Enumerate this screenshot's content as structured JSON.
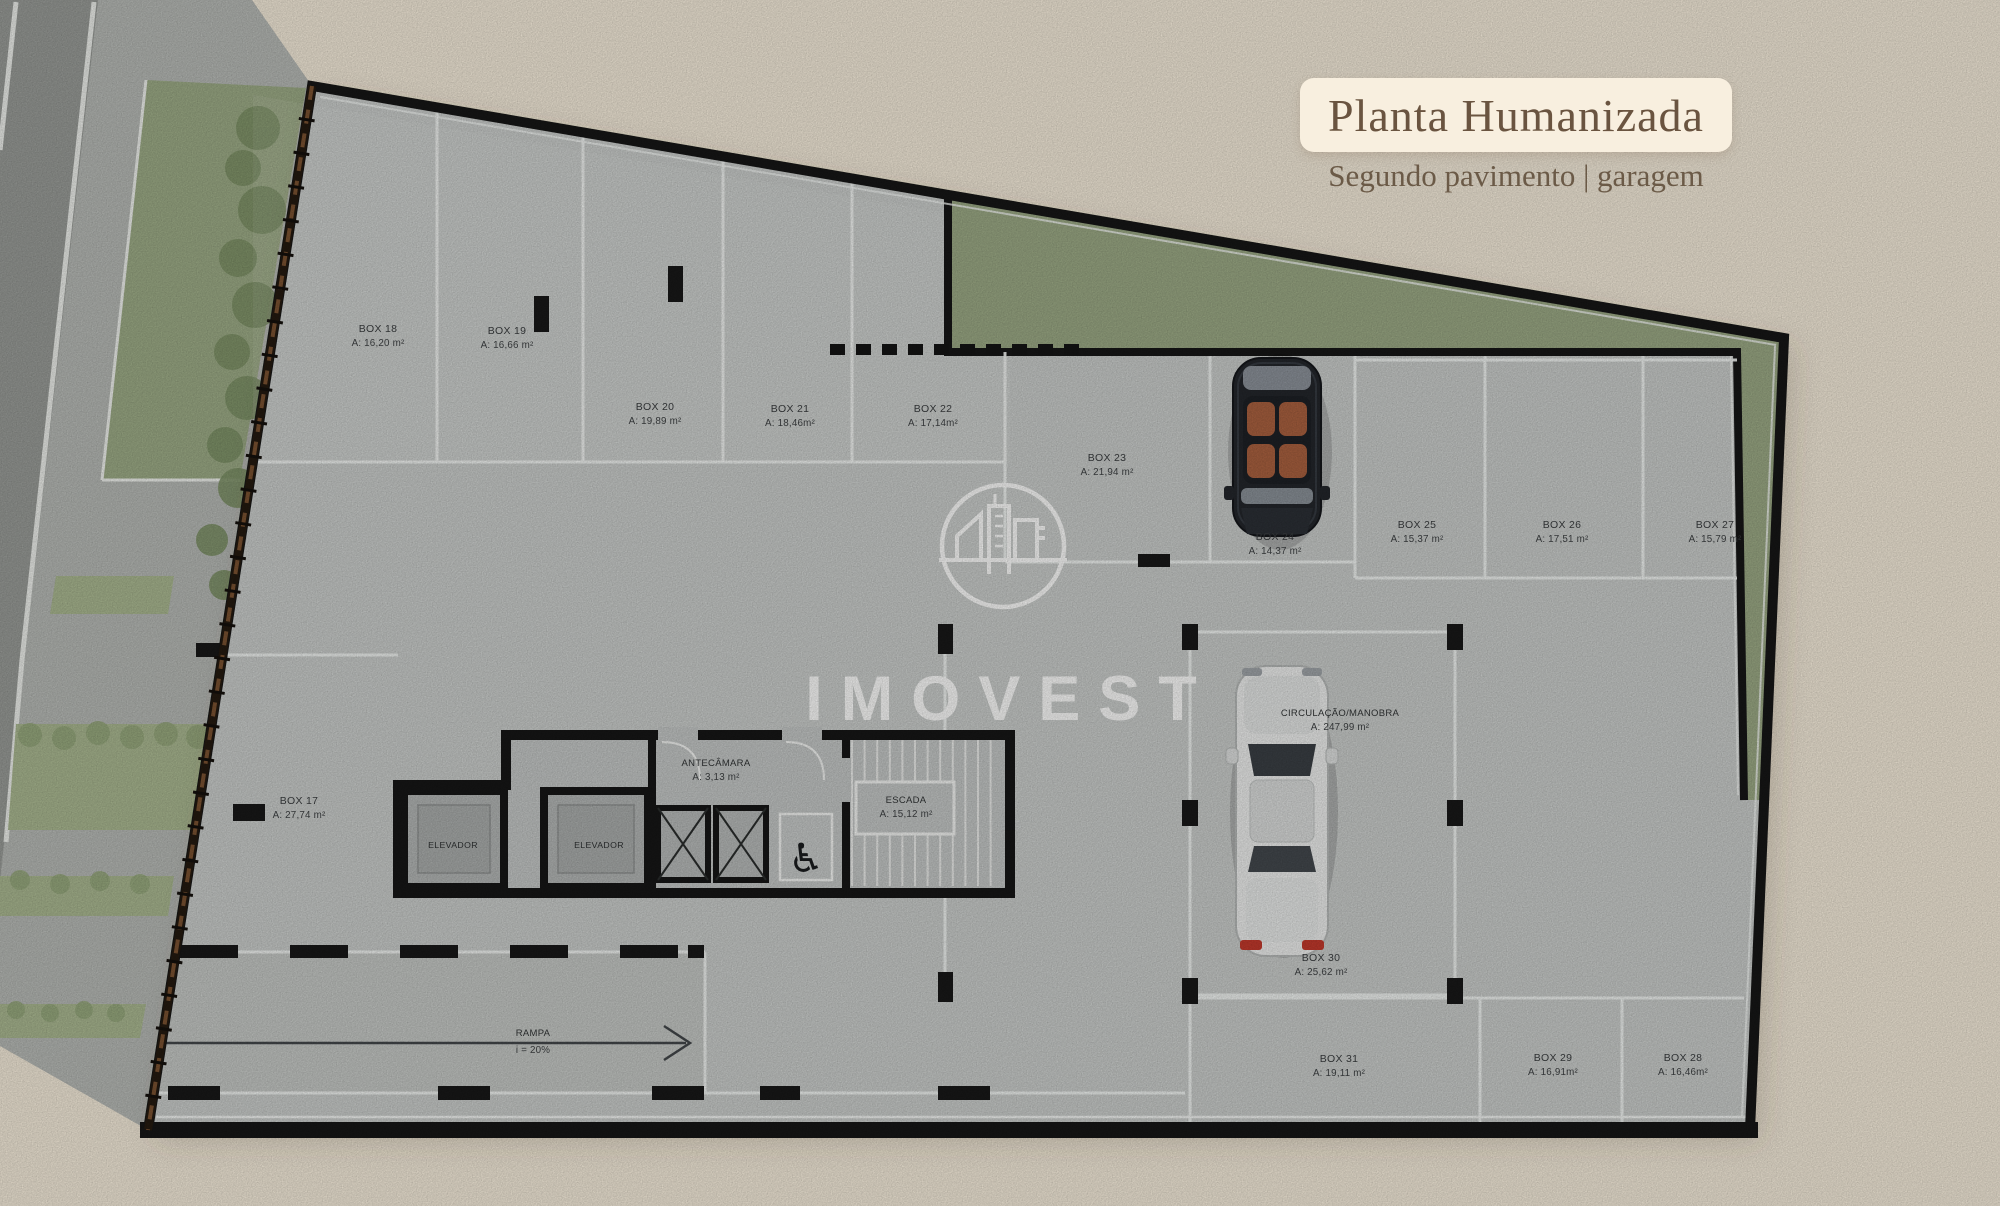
{
  "header": {
    "title": "Planta Humanizada",
    "subtitle": "Segundo pavimento | garagem"
  },
  "brand": {
    "name": "IMOVEST",
    "logo_icon": "building-circle-logo"
  },
  "plan": {
    "stalls": [
      {
        "name": "BOX 18",
        "area": "A: 16,20 m²",
        "x": 378,
        "y": 338
      },
      {
        "name": "BOX 19",
        "area": "A: 16,66 m²",
        "x": 507,
        "y": 340
      },
      {
        "name": "BOX 20",
        "area": "A: 19,89 m²",
        "x": 655,
        "y": 416
      },
      {
        "name": "BOX 21",
        "area": "A: 18,46m²",
        "x": 790,
        "y": 418
      },
      {
        "name": "BOX 22",
        "area": "A: 17,14m²",
        "x": 933,
        "y": 418
      },
      {
        "name": "BOX 23",
        "area": "A: 21,94 m²",
        "x": 1107,
        "y": 467
      },
      {
        "name": "BOX 24",
        "area": "A: 14,37 m²",
        "x": 1275,
        "y": 546
      },
      {
        "name": "BOX 25",
        "area": "A: 15,37 m²",
        "x": 1417,
        "y": 534
      },
      {
        "name": "BOX 26",
        "area": "A: 17,51 m²",
        "x": 1562,
        "y": 534
      },
      {
        "name": "BOX 27",
        "area": "A: 15,79 m²",
        "x": 1715,
        "y": 534
      },
      {
        "name": "BOX 17",
        "area": "A: 27,74 m²",
        "x": 299,
        "y": 810
      },
      {
        "name": "BOX 30",
        "area": "A: 25,62 m²",
        "x": 1321,
        "y": 967
      },
      {
        "name": "BOX 31",
        "area": "A: 19,11 m²",
        "x": 1339,
        "y": 1068
      },
      {
        "name": "BOX 29",
        "area": "A: 16,91m²",
        "x": 1553,
        "y": 1067
      },
      {
        "name": "BOX 28",
        "area": "A: 16,46m²",
        "x": 1683,
        "y": 1067
      }
    ],
    "rooms": [
      {
        "name": "ELEVADOR",
        "x": 453,
        "y": 848,
        "kind": "elevator"
      },
      {
        "name": "ELEVADOR",
        "x": 599,
        "y": 848,
        "kind": "elevator"
      },
      {
        "name": "ANTECÂMARA",
        "area": "A: 3,13 m²",
        "x": 716,
        "y": 772,
        "kind": "room"
      },
      {
        "name": "ESCADA",
        "area": "A: 15,12 m²",
        "x": 906,
        "y": 809,
        "kind": "room"
      },
      {
        "name": "CIRCULAÇÃO/MANOBRA",
        "area": "A: 247,99 m²",
        "x": 1340,
        "y": 722,
        "kind": "room"
      }
    ],
    "ramp": {
      "name": "RAMPA",
      "slope": "i = 20%",
      "x": 533,
      "y": 1036
    },
    "icons": [
      {
        "name": "wheelchair-accessible-icon",
        "glyph": "♿"
      }
    ]
  },
  "colors": {
    "background": "#f3ead9",
    "floor": "#c9ccca",
    "wall": "#161616",
    "garden": "#9aa884",
    "line": "#eff1ef",
    "title_text": "#6a5440",
    "seat_accent": "#a8603f",
    "taillight": "#c2392c"
  }
}
